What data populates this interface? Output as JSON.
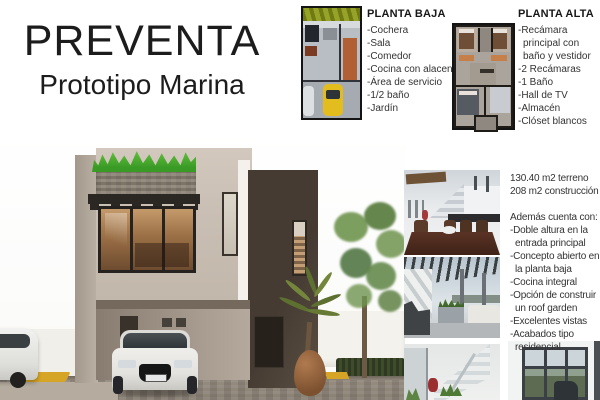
{
  "header": {
    "title": "PREVENTA",
    "subtitle": "Prototipo Marina"
  },
  "planta_baja": {
    "title": "PLANTA BAJA",
    "items": [
      "-Cochera",
      "-Sala",
      "-Comedor",
      "-Cocina con alacena",
      "-Área de servicio",
      "-1/2 baño",
      "-Jardín"
    ]
  },
  "planta_alta": {
    "title": "PLANTA ALTA",
    "items": [
      "-Recámara principal con baño y vestidor",
      "-2 Recámaras",
      "-1 Baño",
      "-Hall de TV",
      "-Almacén",
      "-Clóset blancos"
    ]
  },
  "details": {
    "areas": [
      "130.40 m2 terreno",
      "208 m2 construcción"
    ],
    "features_title": "Además cuenta con:",
    "features": [
      "-Doble altura en la entrada principal",
      "-Concepto abierto en la planta baja",
      "-Cocina integral",
      "-Opción de construir un roof garden",
      "-Excelentes vistas",
      "-Acabados tipo residencial"
    ]
  },
  "images": {
    "main_render": "render-exterior-casa-marina",
    "plan_baja": "plano-planta-baja",
    "plan_alta": "plano-planta-alta",
    "photo_dining": "foto-comedor-cocina",
    "photo_terrace": "foto-roof-garden",
    "photo_stairs": "foto-escalera-doble-altura",
    "photo_window": "foto-ventanal"
  },
  "colors": {
    "facade_beige": "#cabfb4",
    "facade_dark_brown": "#473d33",
    "grass_green": "#4caf32",
    "text_dark": "#1c1c1c"
  }
}
